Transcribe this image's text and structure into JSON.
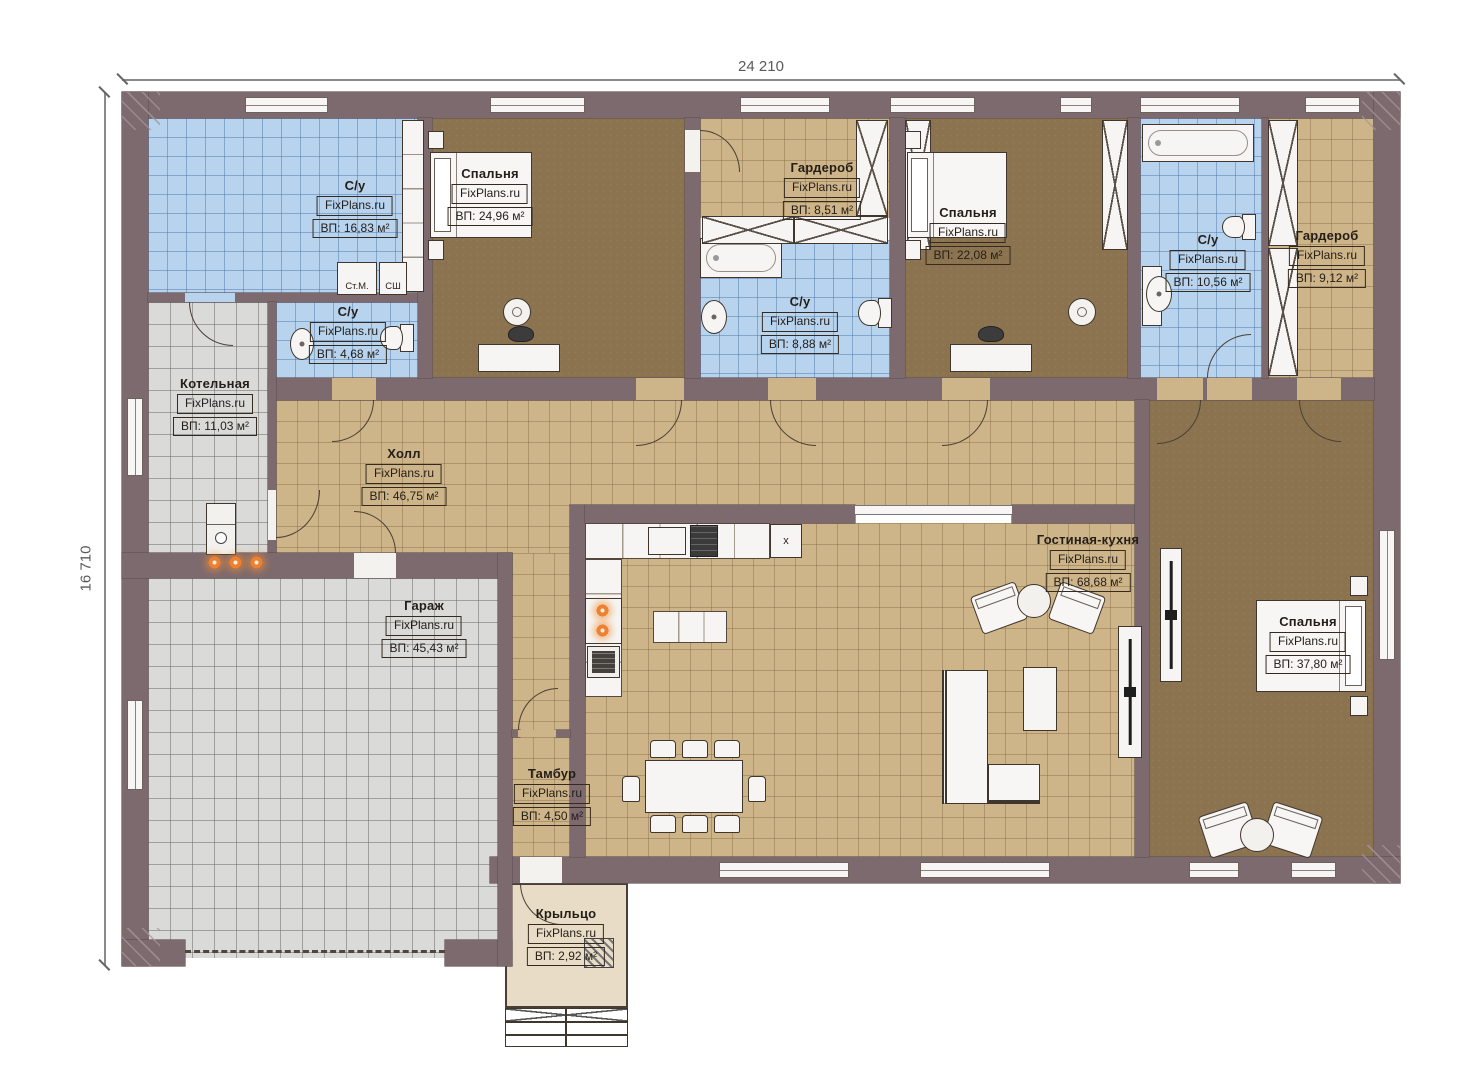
{
  "watermark": "FixPlans.ru",
  "dimensions": {
    "width_mm": "24 210",
    "height_mm": "16 710"
  },
  "rooms": [
    {
      "name": "С/у",
      "area": "ВП: 16,83 м²"
    },
    {
      "name": "Спальня",
      "area": "ВП: 24,96 м²"
    },
    {
      "name": "Гардероб",
      "area": "ВП: 8,51 м²"
    },
    {
      "name": "С/у",
      "area": "ВП: 8,88 м²"
    },
    {
      "name": "Спальня",
      "area": "ВП: 22,08 м²"
    },
    {
      "name": "С/у",
      "area": "ВП: 10,56 м²"
    },
    {
      "name": "Гардероб",
      "area": "ВП: 9,12 м²"
    },
    {
      "name": "С/у",
      "area": "ВП: 4,68 м²"
    },
    {
      "name": "Котельная",
      "area": "ВП: 11,03 м²"
    },
    {
      "name": "Холл",
      "area": "ВП: 46,75 м²"
    },
    {
      "name": "Гараж",
      "area": "ВП: 45,43 м²"
    },
    {
      "name": "Тамбур",
      "area": "ВП: 4,50 м²"
    },
    {
      "name": "Гостиная-кухня",
      "area": "ВП: 68,68 м²"
    },
    {
      "name": "Спальня",
      "area": "ВП: 37,80 м²"
    },
    {
      "name": "Крыльцо",
      "area": "ВП: 2,92 м²"
    }
  ],
  "appliances": {
    "washing_machine": "Ст.М.",
    "dryer": "СШ",
    "hood": "x"
  },
  "colors": {
    "wall": "#7d6a6e",
    "floor_bedroom": "#8c7350",
    "tile_hall": "#cdb489",
    "tile_bath": "#b7d3ed",
    "tile_utility": "#dadad8",
    "porch": "#e8dcc6",
    "flame_accent": "#ef8030"
  }
}
